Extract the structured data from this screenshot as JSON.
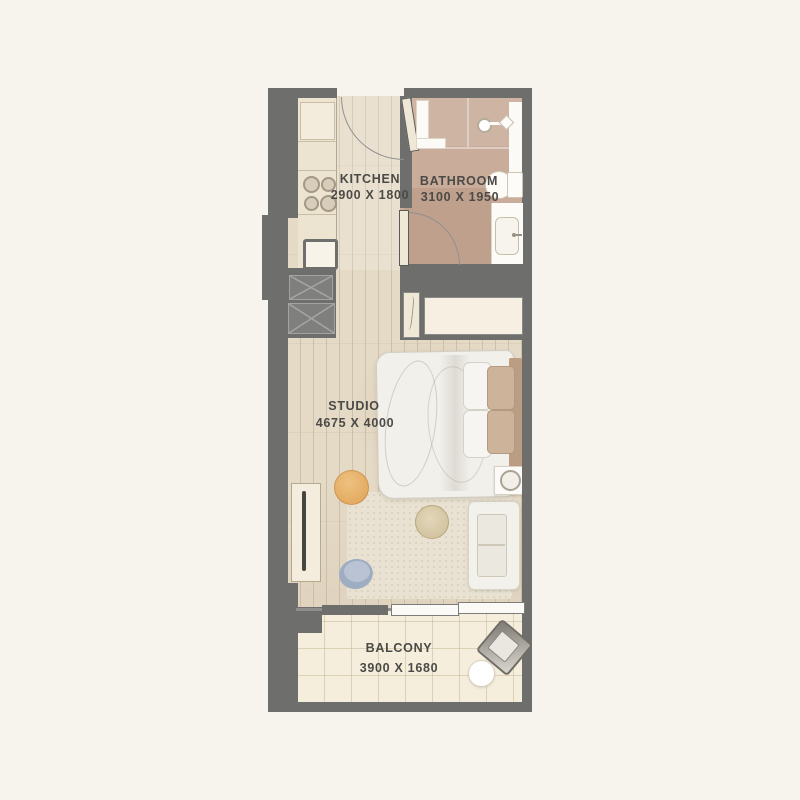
{
  "rooms": {
    "kitchen": {
      "label": "KITCHEN",
      "size": "2900 X 1800"
    },
    "bathroom": {
      "label": "BATHROOM",
      "size": "3100 X 1950"
    },
    "studio": {
      "label": "STUDIO",
      "size": "4675 X 4000"
    },
    "balcony": {
      "label": "BALCONY",
      "size": "3900 X 1680"
    }
  },
  "colors": {
    "wall": "#6e6e6d",
    "wood_floor": "#e4dac6",
    "bathroom_floor": "#c9ac99",
    "balcony_floor": "#f5eedc",
    "background": "#f7f4ee",
    "label_text": "#4b4a47",
    "ottoman_accent": "#e5b06a",
    "pouf_accent": "#a3b0c4"
  },
  "icons": [
    "entrance-door-icon",
    "bathroom-door-icon",
    "stove-icon",
    "kitchen-sink-icon",
    "fridge-icon",
    "shaft-icon",
    "shower-icon",
    "toilet-icon",
    "vanity-sink-icon",
    "bed-icon",
    "pillow-icon",
    "headboard-icon",
    "nightstand-icon",
    "lamp-icon",
    "sofa-icon",
    "rug-icon",
    "coffee-table-icon",
    "ottoman-icon",
    "pouf-icon",
    "tv-console-icon",
    "sliding-door-icon",
    "balcony-chair-icon",
    "balcony-table-icon"
  ]
}
